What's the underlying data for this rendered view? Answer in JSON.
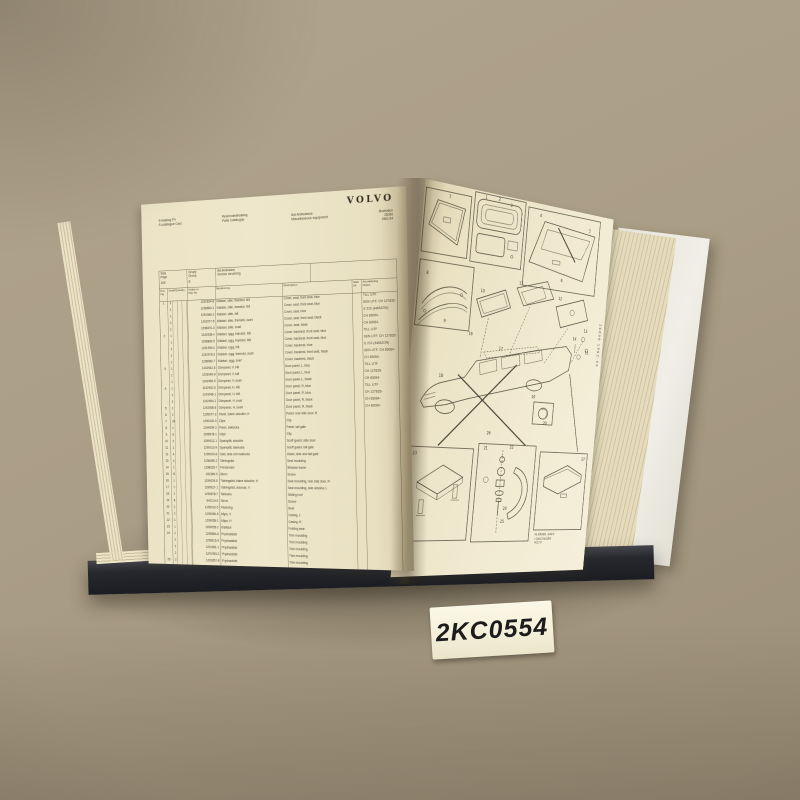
{
  "scene": {
    "background_hex": "#ab9e86",
    "cover_hex": "#26282d",
    "page_hex": "#efe7cb"
  },
  "sticker": {
    "code": "2KC0554"
  },
  "book": {
    "left_page": {
      "brand": "VOLVO",
      "title_sv": "S-katalog PV",
      "title_en": "S-catalogue Cars",
      "doc_sv": "Reservdelskatalog",
      "doc_en": "Parts Catalogue",
      "section_sv": "Äst Ambulans",
      "section_en": "Äst Ambulance",
      "subsection_sv": "Diverse utrustning",
      "subsection_en": "Miscellaneous equipment",
      "illustration_label": "Illustration",
      "illustration_no": "26090",
      "model_years": "1962-64",
      "page_label": "Sida\nPage",
      "page_value": "160",
      "group_label": "Grupp\nGroup",
      "group_value": "8",
      "columns": {
        "pos": "Pos\nFig",
        "qty": "Antal/Quantity",
        "part": "Artikel nr\nPart No",
        "name": "Benämning",
        "desc": "Description",
        "kit": "Sats\nKit",
        "note": "Anmärkning\nNotes"
      },
      "rows": [
        [
          "1",
          "1",
          "1292834-8",
          "Klädsel, säte, framstol, blå",
          "Cover, seat, front seat, blue",
          "",
          "TILL UTF"
        ],
        [
          "",
          "1",
          "1298880-1",
          "Klädsel, säte, framstol, blå",
          "Cover, seat, front seat, blue",
          "",
          "SEN UTF. CH 127835-"
        ],
        [
          "",
          "1",
          "1291989-2",
          "Klädsel, säte, blå",
          "Cover, seat, blue",
          "",
          "S 210 (AMAZON)"
        ],
        [
          "",
          "1",
          "1242977-5",
          "Klädsel, säte, framstol, svart",
          "Cover, seat, front seat, black",
          "",
          "CH 83064-"
        ],
        [
          "",
          "1",
          "1298870-3",
          "Klädsel, säte, svart",
          "Cover, seat, black",
          "",
          "CH 83064-"
        ],
        [
          "2",
          "1",
          "1242938-4",
          "Klädsel, rygg, framstol, blå",
          "Cover, backrest, front seat, blue",
          "",
          "TILL UTF"
        ],
        [
          "",
          "1",
          "1298883-5",
          "Klädsel, rygg, framstol, blå",
          "Cover, backrest, front seat, blue",
          "",
          "SEN UTF. CH 127835-"
        ],
        [
          "",
          "1",
          "1291990-0",
          "Klädsel, rygg, blå",
          "Cover, backrest, blue",
          "",
          "S 210 (AMAZON)"
        ],
        [
          "",
          "1",
          "1242978-3",
          "Klädsel, rygg, framstol, svart",
          "Cover, backrest, front seat, black",
          "",
          "SEN UTF. CH 83064-"
        ],
        [
          "",
          "1",
          "1298982-7",
          "Klädsel, rygg, svart",
          "Cover, backrest, black",
          "",
          "CH 83064-"
        ],
        [
          "3",
          "1",
          "1242942-6",
          "Dörrpanel, V, blå",
          "Door panel, L, blue",
          "",
          "TILL UTF"
        ],
        [
          "",
          "1",
          "1243049-9",
          "Dörrpanel, V, blå",
          "Door panel, L, blue",
          "",
          "CH 127835-"
        ],
        [
          "",
          "1",
          "1242950-9",
          "Dörrpanel, V, svart",
          "Door panel, L, black",
          "",
          "CH 83064-"
        ],
        [
          "4",
          "1",
          "1242952-5",
          "Dörrpanel, H, blå",
          "Door panel, R, blue",
          "",
          "TILL UTF"
        ],
        [
          "",
          "1",
          "1243048-1",
          "Dörrpanel, H, blå",
          "Door panel, R, blue",
          "",
          "CH 127835-"
        ],
        [
          "",
          "1",
          "1242954-1",
          "Dörrpanel, H, svart",
          "Door panel, R, black",
          "",
          "CH 83064-"
        ],
        [
          "5",
          "1",
          "1243958-8",
          "Dörrpanel, H, svart",
          "Door panel, R, black",
          "",
          "CH 83064-"
        ],
        [
          "6",
          "1",
          "1299077-3",
          "Panel, bakre sidodörr, H",
          "Panel, rear side door, R",
          "",
          ""
        ],
        [
          "7",
          "24",
          "1290026-3",
          "Clips",
          "Clip",
          "",
          ""
        ],
        [
          "8",
          "1",
          "1294599-3",
          "Panel, baklucka",
          "Panel, tail gate",
          "",
          ""
        ],
        [
          "9",
          "8",
          "1298978-1",
          "Clips",
          "Clip",
          "",
          ""
        ],
        [
          "10",
          "2",
          "1299012-1",
          "Sparkplåt, sidodörr",
          "Scuff guard, side door",
          "",
          ""
        ],
        [
          "11",
          "1",
          "1299013-9",
          "Sparkplåt, baklucka",
          "Scuff guard, tail gate",
          "",
          ""
        ],
        [
          "12",
          "4",
          "1299024-8",
          "Glas, sida och baklucka",
          "Glass, side and tail gate",
          "",
          ""
        ],
        [
          "13",
          "4",
          "1298089-2",
          "Tätningslist",
          "Seal moulding",
          "",
          ""
        ],
        [
          "14",
          "1",
          "1298635-7",
          "Fönsterram",
          "Window frame",
          "",
          ""
        ],
        [
          "15",
          "8",
          "182389-9",
          "Skruv",
          "Screw",
          "",
          ""
        ],
        [
          "16",
          "1",
          "1299029-8",
          "Tätningslist, bakre sidodörr, H",
          "Seal moulding, rear side door, R",
          "",
          ""
        ],
        [
          "17",
          "1",
          "1299027-1",
          "Tätningslist, sidoruta, V",
          "Seal moulding, side window, L",
          "",
          ""
        ],
        [
          "18",
          "1",
          "1299878-7",
          "Taklucka",
          "Sliding roof",
          "",
          ""
        ],
        [
          "19",
          "8",
          "942114-6",
          "Skruv",
          "Screw",
          "",
          ""
        ],
        [
          "20",
          "1",
          "1299010-5",
          "Packning",
          "Seal",
          "",
          ""
        ],
        [
          "21",
          "1",
          "1299056-5",
          "Kåpa, V",
          "Casing, L",
          "",
          ""
        ],
        [
          "22",
          "1",
          "1299058-1",
          "Kåpa, H",
          "Casing, R",
          "",
          ""
        ],
        [
          "23",
          "1",
          "1299055-2",
          "Klaffstol",
          "Folding seat",
          "",
          ""
        ],
        [
          "24",
          "2",
          "1298584-6",
          "Prydnadslist",
          "Trim moulding",
          "",
          ""
        ],
        [
          "",
          "2",
          "1298615-9",
          "Prydnadslist",
          "Trim moulding",
          "",
          ""
        ],
        [
          "",
          "2",
          "1201851-1",
          "Prydnadslist",
          "Trim moulding",
          "",
          ""
        ],
        [
          "",
          "2",
          "1291953-2",
          "Prydnadslist",
          "Trim moulding",
          "",
          ""
        ],
        [
          "25",
          "2",
          "1201857-8",
          "Prydnadslist",
          "Trim moulding",
          "",
          ""
        ],
        [
          "26",
          "8",
          "1247738-5",
          "Clips",
          "Clip",
          "",
          "ALT 1"
        ],
        [
          "",
          "",
          "",
          "Dekorstejp och kors. För rödlackerad vagn",
          "Stripes and crosses for red painted vehicle",
          "",
          ""
        ],
        [
          "",
          "2",
          "1299504-8",
          "Dekal, framskärm",
          "Decal, front mudguard",
          "",
          ""
        ],
        [
          "",
          "3",
          "1299623-0",
          "Dekal, rött kors, sidodörrar-tak",
          "Decal, red cross, side doors-roof",
          "",
          ""
        ]
      ]
    },
    "right_page": {
      "edge_code": "26090 1962-64",
      "caption_lines": [
        "KLÄDSEL SATS",
        "I DAG INGÅR",
        "HÖJ V"
      ],
      "callouts": [
        {
          "t": "1",
          "x": 70,
          "y": 7
        },
        {
          "t": "2",
          "x": 86,
          "y": 6
        },
        {
          "t": "3",
          "x": 101,
          "y": 10
        },
        {
          "t": "4",
          "x": 139,
          "y": 14
        },
        {
          "t": "5",
          "x": 205,
          "y": 20
        },
        {
          "t": "6",
          "x": 173,
          "y": 80
        },
        {
          "t": "7",
          "x": 28,
          "y": 14
        },
        {
          "t": "8",
          "x": 10,
          "y": 94
        },
        {
          "t": "9",
          "x": 34,
          "y": 140
        },
        {
          "t": "10",
          "x": 74,
          "y": 104
        },
        {
          "t": "11",
          "x": 120,
          "y": 90
        },
        {
          "t": "12",
          "x": 172,
          "y": 100
        },
        {
          "t": "13",
          "x": 210,
          "y": 132
        },
        {
          "t": "14",
          "x": 196,
          "y": 142
        },
        {
          "t": "15",
          "x": 214,
          "y": 156
        },
        {
          "t": "16",
          "x": 64,
          "y": 150
        },
        {
          "t": "17",
          "x": 102,
          "y": 162
        },
        {
          "t": "18",
          "x": 34,
          "y": 196
        },
        {
          "t": "19",
          "x": 148,
          "y": 210
        },
        {
          "t": "20",
          "x": 166,
          "y": 238
        },
        {
          "t": "21",
          "x": 94,
          "y": 268
        },
        {
          "t": "22",
          "x": 126,
          "y": 266
        },
        {
          "t": "23",
          "x": 12,
          "y": 276
        },
        {
          "t": "24",
          "x": 124,
          "y": 332
        },
        {
          "t": "25",
          "x": 122,
          "y": 346
        },
        {
          "t": "26",
          "x": 96,
          "y": 252
        },
        {
          "t": "27",
          "x": 222,
          "y": 276
        }
      ]
    }
  }
}
